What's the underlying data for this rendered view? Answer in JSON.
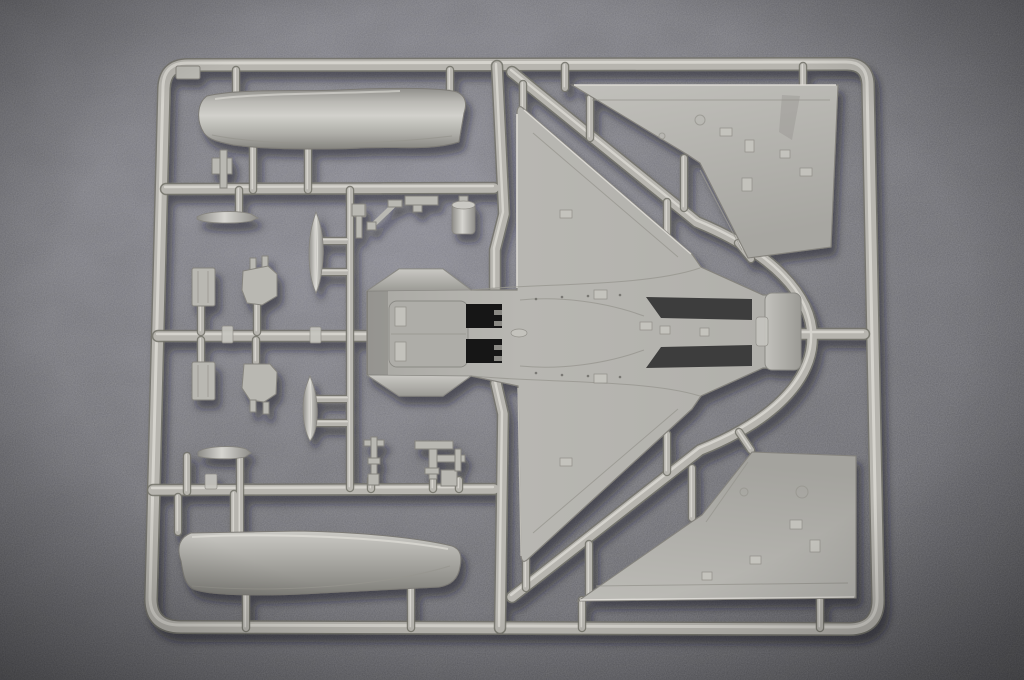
{
  "scene": {
    "type": "photograph",
    "description": "Photograph of a light-gray injection-molded plastic model kit sprue for a delta-wing jet aircraft, lying on dark gray felt fabric. The rectangular runner frame holds a one-piece fuselage with delta wings in the center, two triangular wing panels at the upper-right and lower-right, long curved fuselage covers at the upper-left and lower-left, and many small parts (drop-tank halves, bay doors, blade fairings, probes and brackets) attached to inner runners.",
    "colors": {
      "fabric_base": "#77777c",
      "fabric_light": "#8e8e93",
      "fabric_dark": "#56565b",
      "runner": "#b7b5af",
      "runner_highlight": "#dfddd7",
      "runner_shadow": "#76746d",
      "part_surface": "#b2b1ac",
      "part_bright": "#cfcec9",
      "part_dark": "#8e8d89",
      "opening_black": "#141414",
      "cast_shadow": "#17171a"
    },
    "sprue": {
      "frame": {
        "name": "sprue-frame",
        "region": [
          150,
          62,
          730,
          572
        ]
      },
      "parts": [
        {
          "name": "upper-fuselage-cover",
          "region": [
            200,
            88,
            267,
            62
          ]
        },
        {
          "name": "lower-fuselage-cover",
          "region": [
            175,
            530,
            286,
            66
          ]
        },
        {
          "name": "main-airframe-with-delta-wings",
          "region": [
            367,
            104,
            433,
            461
          ]
        },
        {
          "name": "intake-openings",
          "region": [
            466,
            304,
            36,
            59
          ]
        },
        {
          "name": "tail-end-plate",
          "region": [
            765,
            293,
            36,
            77
          ]
        },
        {
          "name": "upper-right-wing-panel",
          "region": [
            572,
            85,
            266,
            175
          ]
        },
        {
          "name": "lower-right-wing-panel",
          "region": [
            578,
            452,
            280,
            149
          ]
        },
        {
          "name": "drop-tank-half-upper",
          "region": [
            309,
            212,
            15,
            81
          ]
        },
        {
          "name": "drop-tank-half-lower",
          "region": [
            303,
            376,
            15,
            65
          ]
        },
        {
          "name": "blade-fairing-upper",
          "region": [
            196,
            211,
            62,
            13
          ]
        },
        {
          "name": "blade-fairing-lower",
          "region": [
            197,
            445,
            54,
            14
          ]
        },
        {
          "name": "bay-door-upper",
          "region": [
            192,
            268,
            23,
            38
          ]
        },
        {
          "name": "bay-door-lower",
          "region": [
            192,
            362,
            23,
            38
          ]
        },
        {
          "name": "gear-bay-box-upper",
          "region": [
            242,
            256,
            36,
            50
          ]
        },
        {
          "name": "gear-bay-box-lower",
          "region": [
            242,
            362,
            36,
            52
          ]
        },
        {
          "name": "small-bracket-top-left",
          "region": [
            211,
            150,
            22,
            40
          ]
        },
        {
          "name": "small-bracket-mid",
          "region": [
            352,
            196,
            16,
            42
          ]
        },
        {
          "name": "small-strut",
          "region": [
            368,
            200,
            34,
            30
          ]
        },
        {
          "name": "flat-bracket",
          "region": [
            405,
            196,
            33,
            16
          ]
        },
        {
          "name": "capped-cylinder",
          "region": [
            452,
            196,
            26,
            44
          ]
        },
        {
          "name": "probe-pin-1",
          "region": [
            364,
            437,
            20,
            51
          ]
        },
        {
          "name": "probe-pin-2",
          "region": [
            415,
            441,
            38,
            38
          ]
        },
        {
          "name": "probe-pin-3",
          "region": [
            425,
            455,
            40,
            35
          ]
        }
      ],
      "runners": [
        {
          "name": "runner-horizontal-top",
          "y": 188
        },
        {
          "name": "runner-horizontal-middle",
          "y": 336
        },
        {
          "name": "runner-horizontal-bottom",
          "y": 490
        },
        {
          "name": "runner-vertical-center",
          "x": 498
        },
        {
          "name": "runner-small-parts-column",
          "x": 350
        },
        {
          "name": "runner-diagonal-and-tail-arc",
          "path": "top frame to bottom frame around fuselage tail"
        },
        {
          "name": "runner-tail-stub",
          "y": 334
        }
      ]
    }
  }
}
